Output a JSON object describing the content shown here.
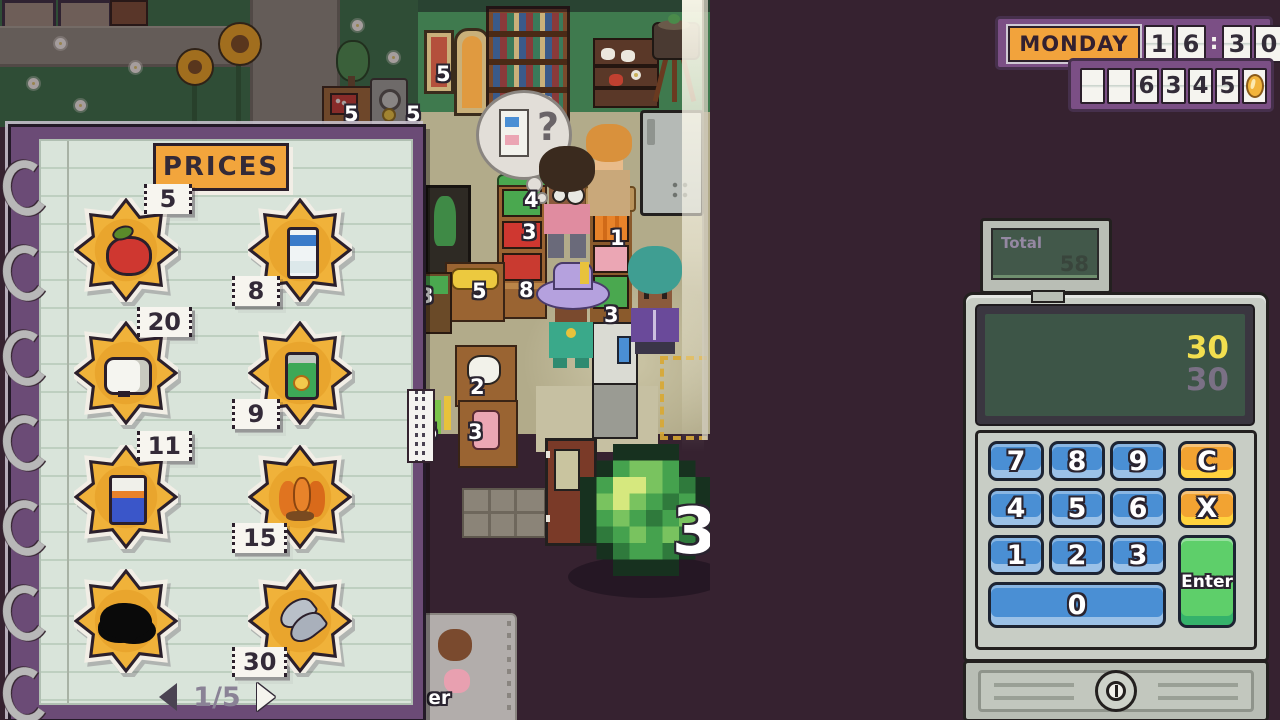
{
  "hud": {
    "day": "MONDAY",
    "time_cells": [
      "1",
      "6",
      ":",
      "3",
      "0"
    ],
    "money_cells": [
      "",
      "",
      "6",
      "3",
      "4",
      "5"
    ],
    "coin_icon": "gold-coin-icon"
  },
  "notebook": {
    "title": "PRICES",
    "page_indicator": "1/5",
    "prev_icon": "left-arrow",
    "next_icon": "right-arrow",
    "items": [
      {
        "icon": "apple-icon",
        "price": "5"
      },
      {
        "icon": "milk-carton-icon",
        "price": "8"
      },
      {
        "icon": "toilet-paper-icon",
        "price": "20"
      },
      {
        "icon": "canned-drink-icon",
        "price": "9"
      },
      {
        "icon": "fish-food-box-icon",
        "price": "11"
      },
      {
        "icon": "carrots-icon",
        "price": "15"
      },
      {
        "icon": "unknown-item-icon",
        "price": ""
      },
      {
        "icon": "fish-icon",
        "price": "30"
      }
    ]
  },
  "register": {
    "monitor": {
      "label": "Total",
      "value": "58"
    },
    "display": {
      "entered": "30",
      "target": "30"
    },
    "keys": [
      {
        "label": "7"
      },
      {
        "label": "8"
      },
      {
        "label": "9"
      },
      {
        "label": "C"
      },
      {
        "label": "4"
      },
      {
        "label": "5"
      },
      {
        "label": "6"
      },
      {
        "label": "X"
      },
      {
        "label": "1"
      },
      {
        "label": "2"
      },
      {
        "label": "3"
      },
      {
        "label": "Enter"
      },
      {
        "label": "0"
      }
    ]
  },
  "scene": {
    "thought_bubble_text": "?",
    "item_callout": {
      "item": "cabbage",
      "value": "3"
    },
    "shelf_price_tags": [
      "5",
      "5",
      "5",
      "4",
      "3",
      "8",
      "1",
      "3",
      "5",
      "3",
      "2",
      "5",
      "3"
    ],
    "receipt_text": "er"
  }
}
